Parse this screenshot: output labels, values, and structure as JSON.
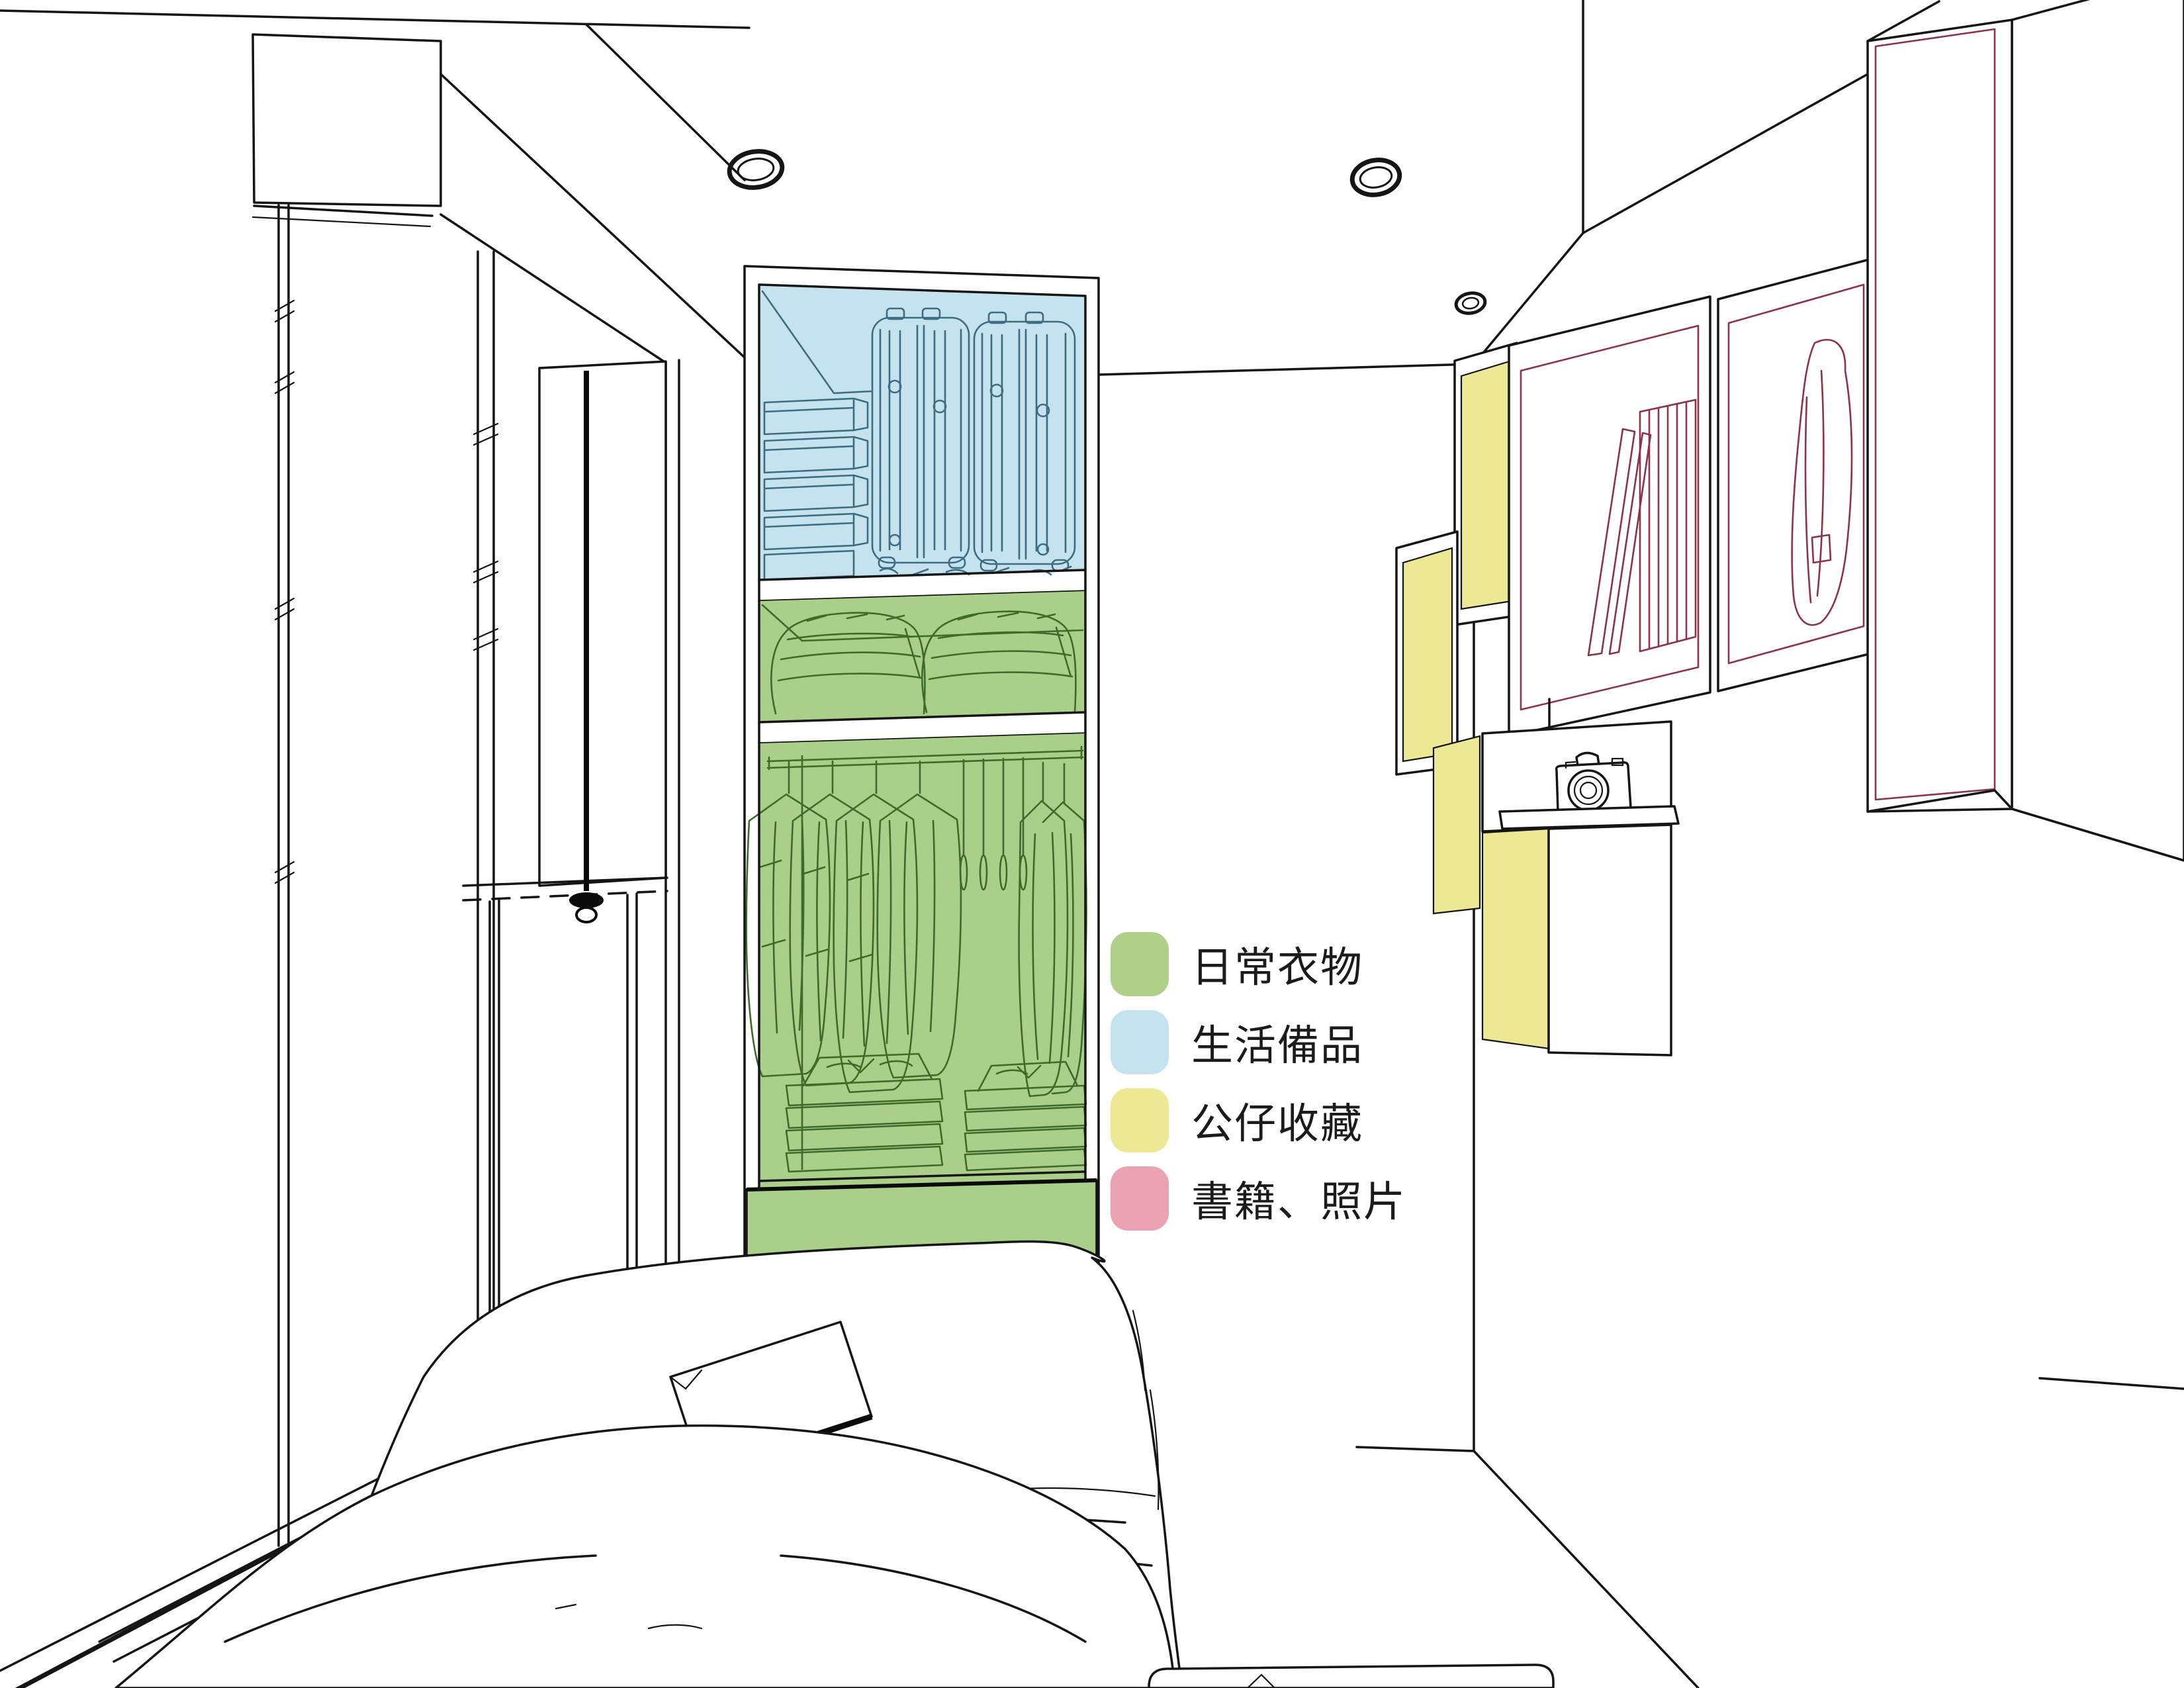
{
  "legend": {
    "items": [
      {
        "id": "daily-clothes",
        "label": "日常衣物",
        "color": "#aed089"
      },
      {
        "id": "daily-supplies",
        "label": "生活備品",
        "color": "#c5e2ef"
      },
      {
        "id": "figure-collection",
        "label": "公仔收藏",
        "color": "#ece893"
      },
      {
        "id": "books-photos",
        "label": "書籍、照片",
        "color": "#eba3b2"
      }
    ]
  },
  "scene": {
    "type": "interior-design line rendering of a small bedroom",
    "highlight_zones": [
      {
        "zone": "wardrobe-upper-cabinet",
        "category": "生活備品",
        "color": "#c5e2ef",
        "contents": [
          "storage boxes",
          "two suitcases"
        ]
      },
      {
        "zone": "wardrobe-duvet-shelf-and-hanging-area",
        "category": "日常衣物",
        "color": "#aed089",
        "contents": [
          "folded duvets",
          "hanging clothes",
          "empty hangers",
          "folded clothes stacks",
          "drawer base"
        ]
      },
      {
        "zone": "right-wall-display-boxes",
        "category": "公仔收藏",
        "color": "#ece893"
      },
      {
        "zone": "right-wall-shelves-and-tall-cabinet",
        "category": "書籍、照片",
        "color": "#eba3b2",
        "contents": [
          "books",
          "bag sketch"
        ]
      }
    ],
    "objects": [
      "ceiling recessed lights (3)",
      "window with roller blind and pull cord",
      "open wardrobe",
      "bed with duvet and book",
      "step platform",
      "camera on shelf",
      "wall-hung cabinets"
    ]
  },
  "colors": {
    "background": "#ffffff",
    "outline": "#151515",
    "blue_line": "#3e6d82",
    "green_line": "#3f6a2b",
    "pink_line": "#8e3247"
  }
}
